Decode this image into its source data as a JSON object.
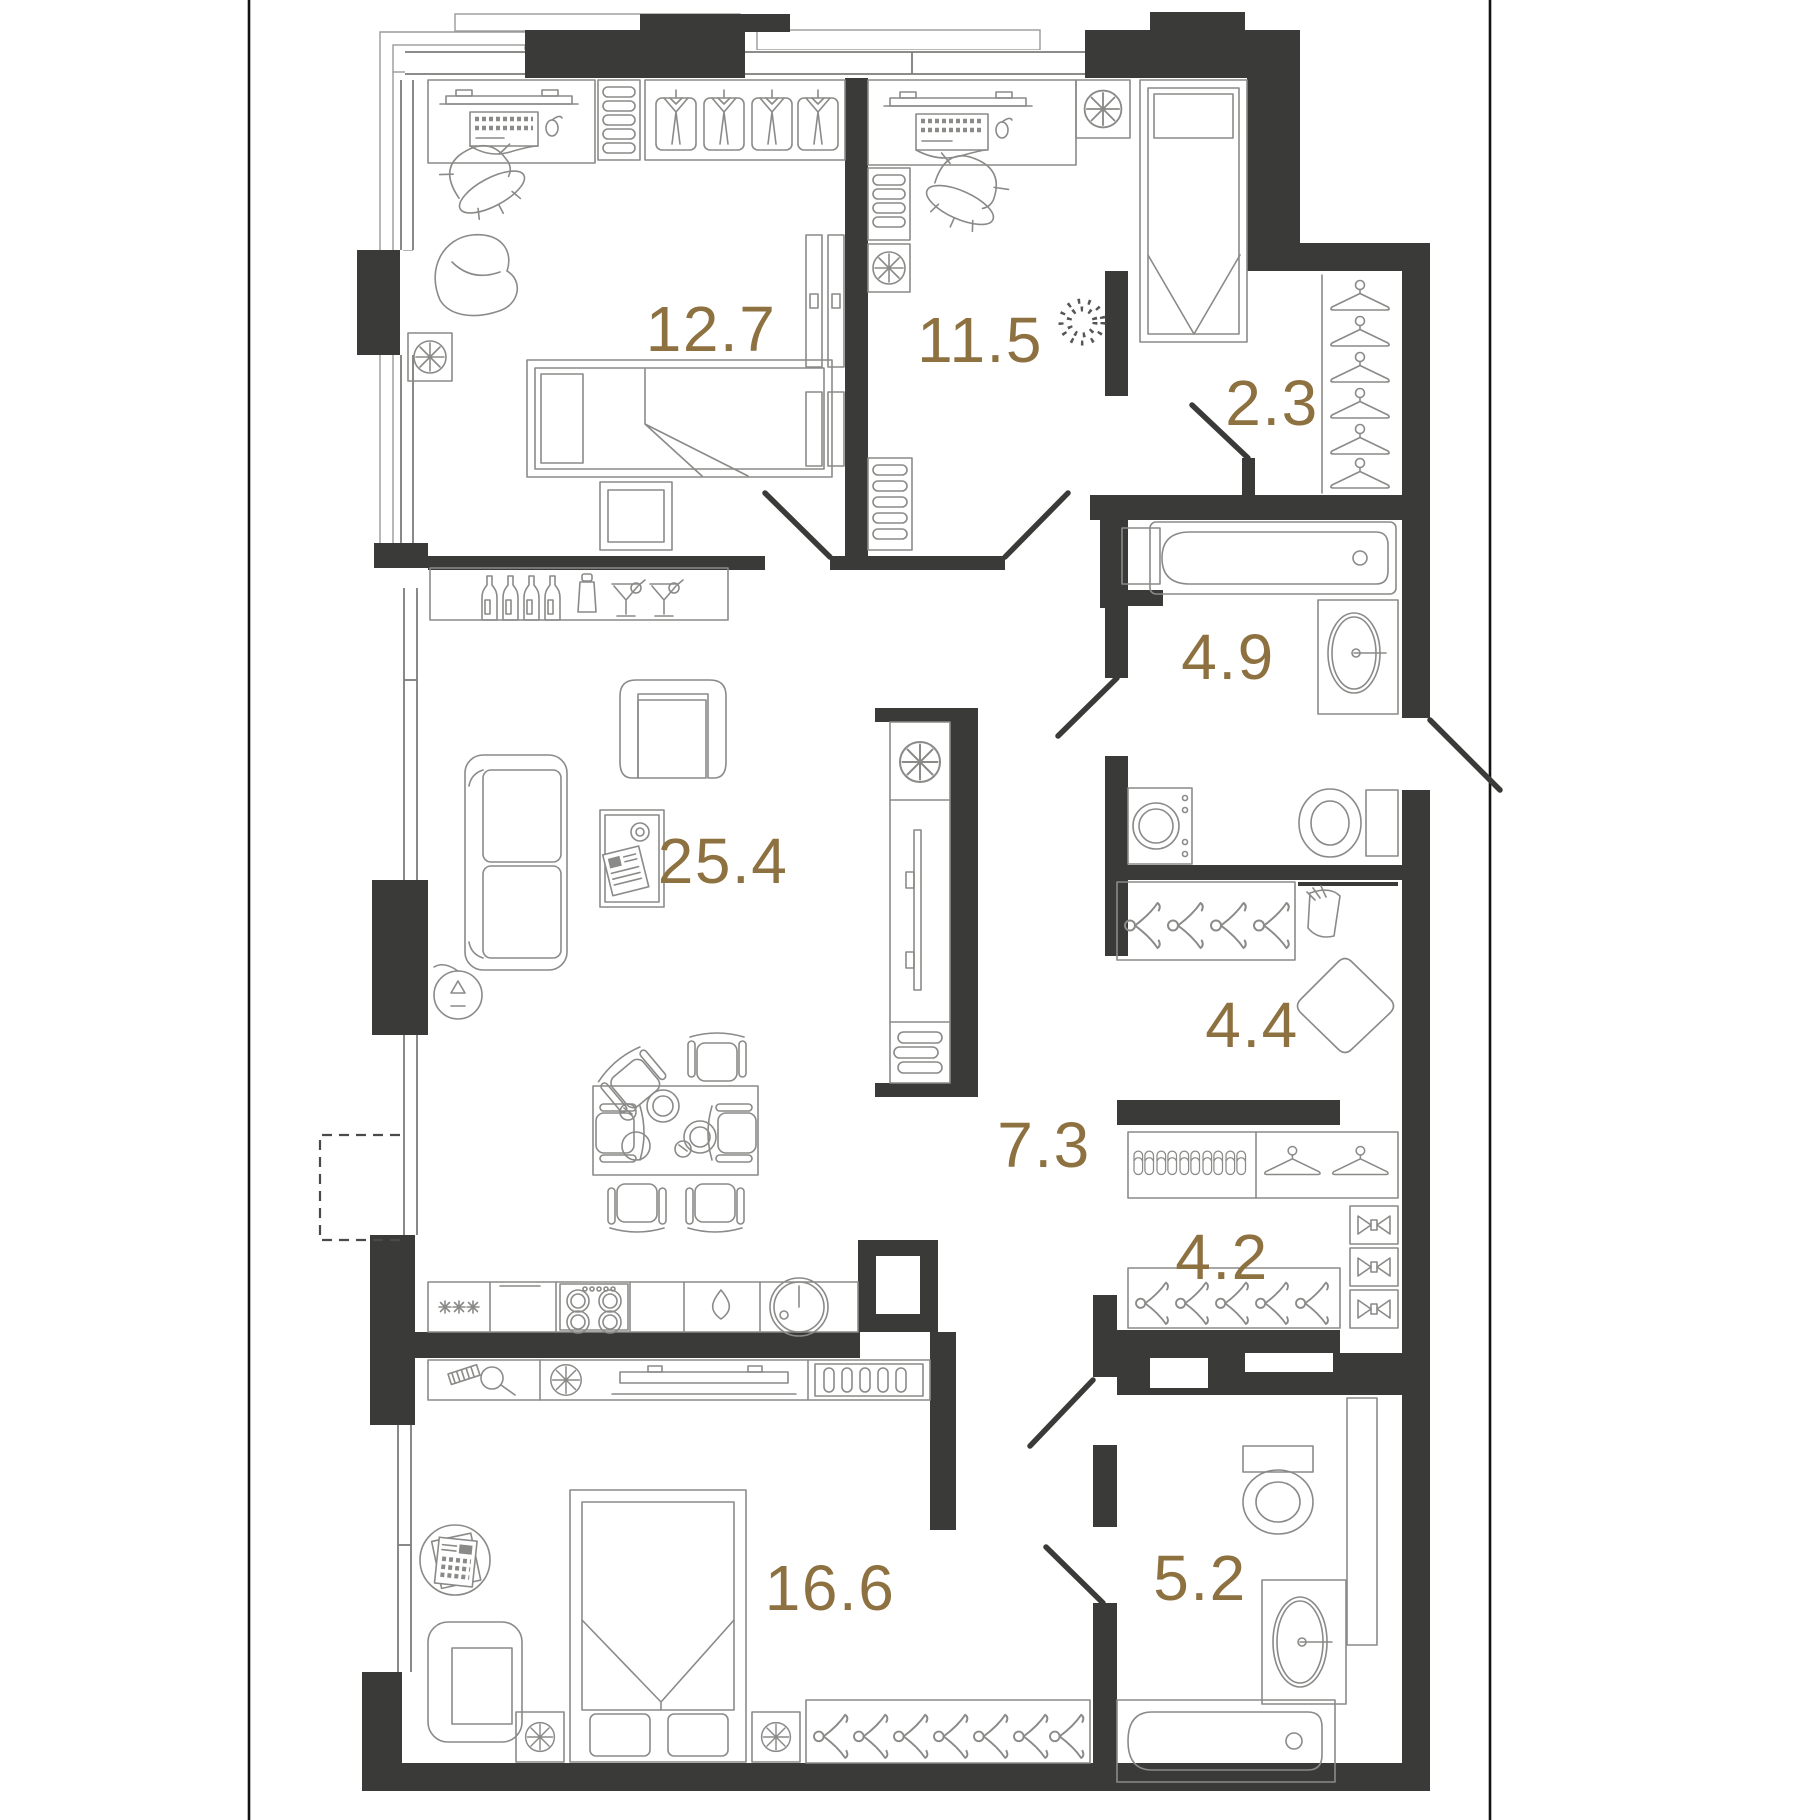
{
  "document": {
    "type": "apartment-floor-plan",
    "units_note": ""
  },
  "colors": {
    "background": "#ffffff",
    "wall": "#3a3a38",
    "furniture_line": "#8a8a88",
    "room_label": "#8e7140",
    "thin_line": "#9a9a98",
    "border_rule": "#141414"
  },
  "rooms": [
    {
      "id": "bedroom-top-left",
      "area": "12.7",
      "label": {
        "x": 711,
        "y": 334
      },
      "furniture": [
        "desk-icon",
        "keyboard-icon",
        "mouse-icon",
        "office-chair-icon",
        "bean-bag-icon",
        "shelf-icon",
        "wardrobe-shirts-icon",
        "radiator-icon",
        "single-bed-icon",
        "tv-icon"
      ]
    },
    {
      "id": "bedroom-top-middle",
      "area": "11.5",
      "label": {
        "x": 980,
        "y": 345
      },
      "furniture": [
        "desk-icon",
        "keyboard-icon",
        "mouse-icon",
        "office-chair-icon",
        "shelf-icon",
        "radiator-icon",
        "single-bed-icon",
        "plant-icon"
      ]
    },
    {
      "id": "closet-top",
      "area": "2.3",
      "label": {
        "x": 1272,
        "y": 408
      },
      "furniture": [
        "hangers-icon"
      ]
    },
    {
      "id": "bathroom-top",
      "area": "4.9",
      "label": {
        "x": 1228,
        "y": 662
      },
      "furniture": [
        "bathtub-icon",
        "sink-icon",
        "toilet-icon",
        "washing-machine-icon",
        "duct-icon"
      ]
    },
    {
      "id": "living-kitchen",
      "area": "25.4",
      "label": {
        "x": 723,
        "y": 866
      },
      "furniture": [
        "bar-shelf-icon",
        "bottles-icon",
        "shaker-icon",
        "martini-glasses-icon",
        "armchair-icon",
        "sofa-icon",
        "coffee-table-icon",
        "floor-lamp-icon",
        "dining-table-icon",
        "chairs-icon",
        "tv-stand-icon",
        "fridge-icon",
        "stove-icon",
        "kitchen-sink-icon"
      ]
    },
    {
      "id": "hallway",
      "area": "4.4",
      "label": {
        "x": 1252,
        "y": 1030
      },
      "furniture": [
        "coat-hangers-icon",
        "mirror-icon",
        "pouf-icon"
      ]
    },
    {
      "id": "corridor",
      "area": "7.3",
      "label": {
        "x": 1044,
        "y": 1150
      },
      "furniture": []
    },
    {
      "id": "wardrobe-room",
      "area": "4.2",
      "label": {
        "x": 1222,
        "y": 1262
      },
      "furniture": [
        "slippers-icon",
        "hangers-icon",
        "folded-shirts-boxes-icon"
      ]
    },
    {
      "id": "bedroom-bottom",
      "area": "16.6",
      "label": {
        "x": 830,
        "y": 1593
      },
      "furniture": [
        "double-bed-icon",
        "nightstand-icon",
        "armchair-icon",
        "newspaper-icon",
        "dresser-icon",
        "tv-icon",
        "hangers-icon"
      ]
    },
    {
      "id": "bathroom-bottom",
      "area": "5.2",
      "label": {
        "x": 1200,
        "y": 1583
      },
      "furniture": [
        "toilet-icon",
        "sink-icon",
        "bathtub-icon",
        "duct-icon"
      ]
    }
  ]
}
